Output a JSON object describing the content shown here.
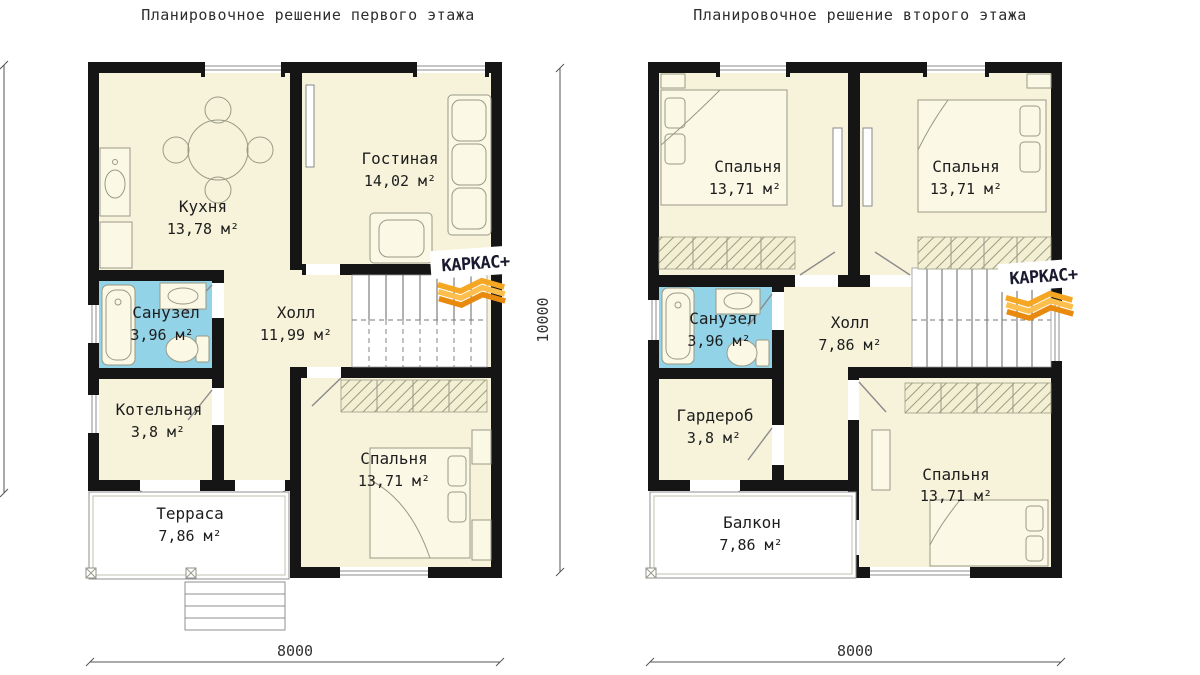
{
  "titles": {
    "first": "Планировочное решение первого этажа",
    "second": "Планировочное решение второго этажа"
  },
  "floor1": {
    "rooms": [
      {
        "name": "Кухня",
        "area": "13,78 м²"
      },
      {
        "name": "Гостиная",
        "area": "14,02 м²"
      },
      {
        "name": "Санузел",
        "area": "3,96 м²"
      },
      {
        "name": "Холл",
        "area": "11,99 м²"
      },
      {
        "name": "Котельная",
        "area": "3,8 м²"
      },
      {
        "name": "Спальня",
        "area": "13,71 м²"
      },
      {
        "name": "Терраса",
        "area": "7,86 м²"
      }
    ]
  },
  "floor2": {
    "rooms": [
      {
        "name": "Спальня",
        "area": "13,71 м²"
      },
      {
        "name": "Спальня",
        "area": "13,71 м²"
      },
      {
        "name": "Санузел",
        "area": "3,96 м²"
      },
      {
        "name": "Холл",
        "area": "7,86 м²"
      },
      {
        "name": "Гардероб",
        "area": "3,8 м²"
      },
      {
        "name": "Спальня",
        "area": "13,71 м²"
      },
      {
        "name": "Балкон",
        "area": "7,86 м²"
      }
    ]
  },
  "dimensions": {
    "width_first": "8000",
    "width_second": "8000",
    "depth": "10000"
  },
  "logo": {
    "text": "КАРКАС+"
  },
  "colors": {
    "wall": "#151515",
    "room_fill": "#f6f3da",
    "bath_fill": "#92d3e7",
    "furniture_stroke": "#9a9a85",
    "logo_text": "#191930",
    "logo_orange1": "#f5a623",
    "logo_orange2": "#fcbf4e",
    "logo_orange3": "#e88a0e"
  }
}
